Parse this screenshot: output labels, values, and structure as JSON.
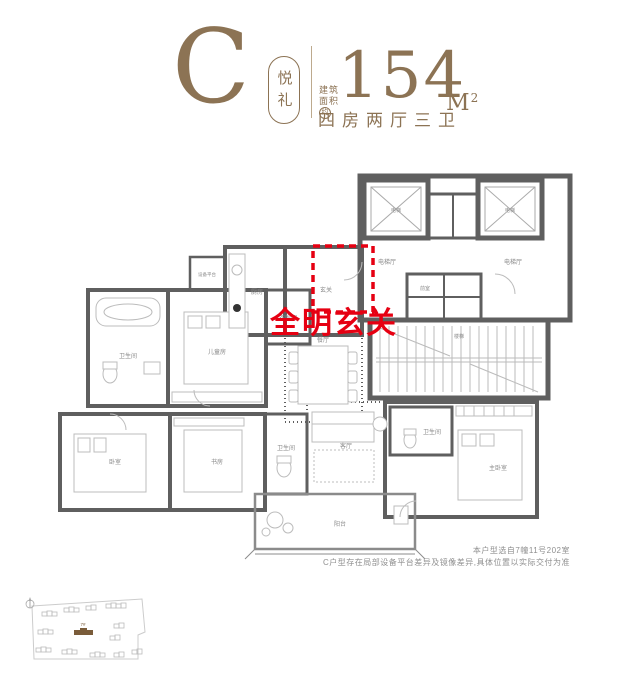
{
  "colors": {
    "brand_brown": "#8c7354",
    "accent_red": "#e60012",
    "wall_gray": "#5f5f5f"
  },
  "header": {
    "type_letter": "C",
    "badge": "悦礼",
    "area_label_line1": "建筑",
    "area_label_line2": "面积",
    "area_label_circled": "约",
    "area_value": "154",
    "area_unit_letter": "M",
    "area_unit_sup": "2",
    "layout_desc": "四房两厅三卫"
  },
  "floorplan": {
    "highlight_text": "全明玄关",
    "rooms": {
      "entry": "玄关",
      "kitchen": "厨房",
      "equipment": "设备平台",
      "dining": "餐厅",
      "living": "客厅",
      "balcony": "阳台",
      "master_bedroom": "主卧室",
      "bedroom2": "卧室",
      "study": "书房",
      "kids_room": "儿童房",
      "cloakroom": "衣帽间",
      "bath1": "卫生间",
      "bath2": "卫生间",
      "bath3": "卫生间",
      "elevator_hall_left": "电梯厅",
      "elevator_hall_right": "电梯厅",
      "elevator1": "电梯",
      "elevator2": "电梯",
      "front_room": "前室",
      "stairs": "楼梯"
    }
  },
  "notes": {
    "line1": "本户型选自7幢11号202室",
    "line2": "C户型存在局部设备平台差异及镜像差异,具体位置以实际交付为准"
  },
  "siteplan": {
    "highlighted_building": "7#"
  }
}
